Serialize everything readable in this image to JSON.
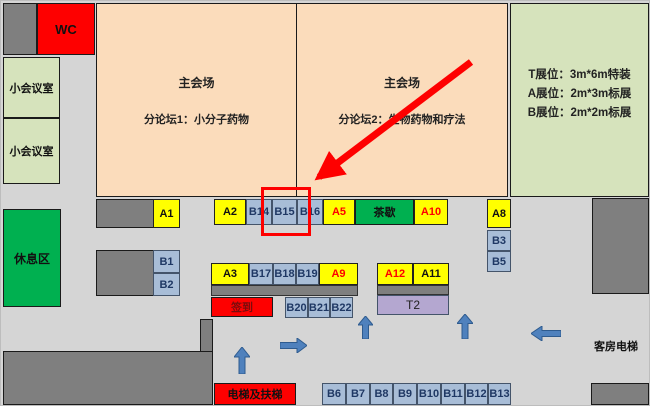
{
  "halls": {
    "left": {
      "title": "主会场",
      "subtitle": "分论坛1：小分子药物"
    },
    "right": {
      "title": "主会场",
      "subtitle": "分论坛2：生物药物和疗法"
    }
  },
  "legend": {
    "t_line": "T展位：3m*6m特装",
    "a_line": "A展位：2m*3m标展",
    "b_line": "B展位：2m*2m标展"
  },
  "areas": {
    "wc": "WC",
    "meeting_room_upper": "小会议室",
    "meeting_room_lower": "小会议室",
    "rest_area": "休息区",
    "tea_break": "茶歇",
    "sign_in": "签到",
    "elevator_escalator": "电梯及扶梯",
    "guest_room_elevator": "客房电梯"
  },
  "booths": {
    "A1": "A1",
    "A2": "A2",
    "A3": "A3",
    "A5": "A5",
    "A8": "A8",
    "A9": "A9",
    "A10": "A10",
    "A11": "A11",
    "A12": "A12",
    "B1": "B1",
    "B2": "B2",
    "B3": "B3",
    "B5": "B5",
    "B6": "B6",
    "B7": "B7",
    "B8": "B8",
    "B9": "B9",
    "B10": "B10",
    "B11": "B11",
    "B12": "B12",
    "B13": "B13",
    "B14": "B14",
    "B15": "B15",
    "B16": "B16",
    "B17": "B17",
    "B18": "B18",
    "B19": "B19",
    "B20": "B20",
    "B21": "B21",
    "B22": "B22",
    "T2": "T2"
  },
  "highlight": {
    "target_booth": "B15"
  },
  "colors": {
    "booth_yellow": "#ffff00",
    "booth_blue": "#a8bdd7",
    "booth_blue_text": "#1f3864",
    "hall_peach": "#fbdcbb",
    "legend_green": "#d6e3bc",
    "area_green": "#00b050",
    "wall_grey": "#7f7f7f",
    "corridor_grey": "#d5d5d5",
    "t2_lavender": "#b4a7d0",
    "alert_red": "#fe0000",
    "arrow_blue": "#4f81bd"
  }
}
